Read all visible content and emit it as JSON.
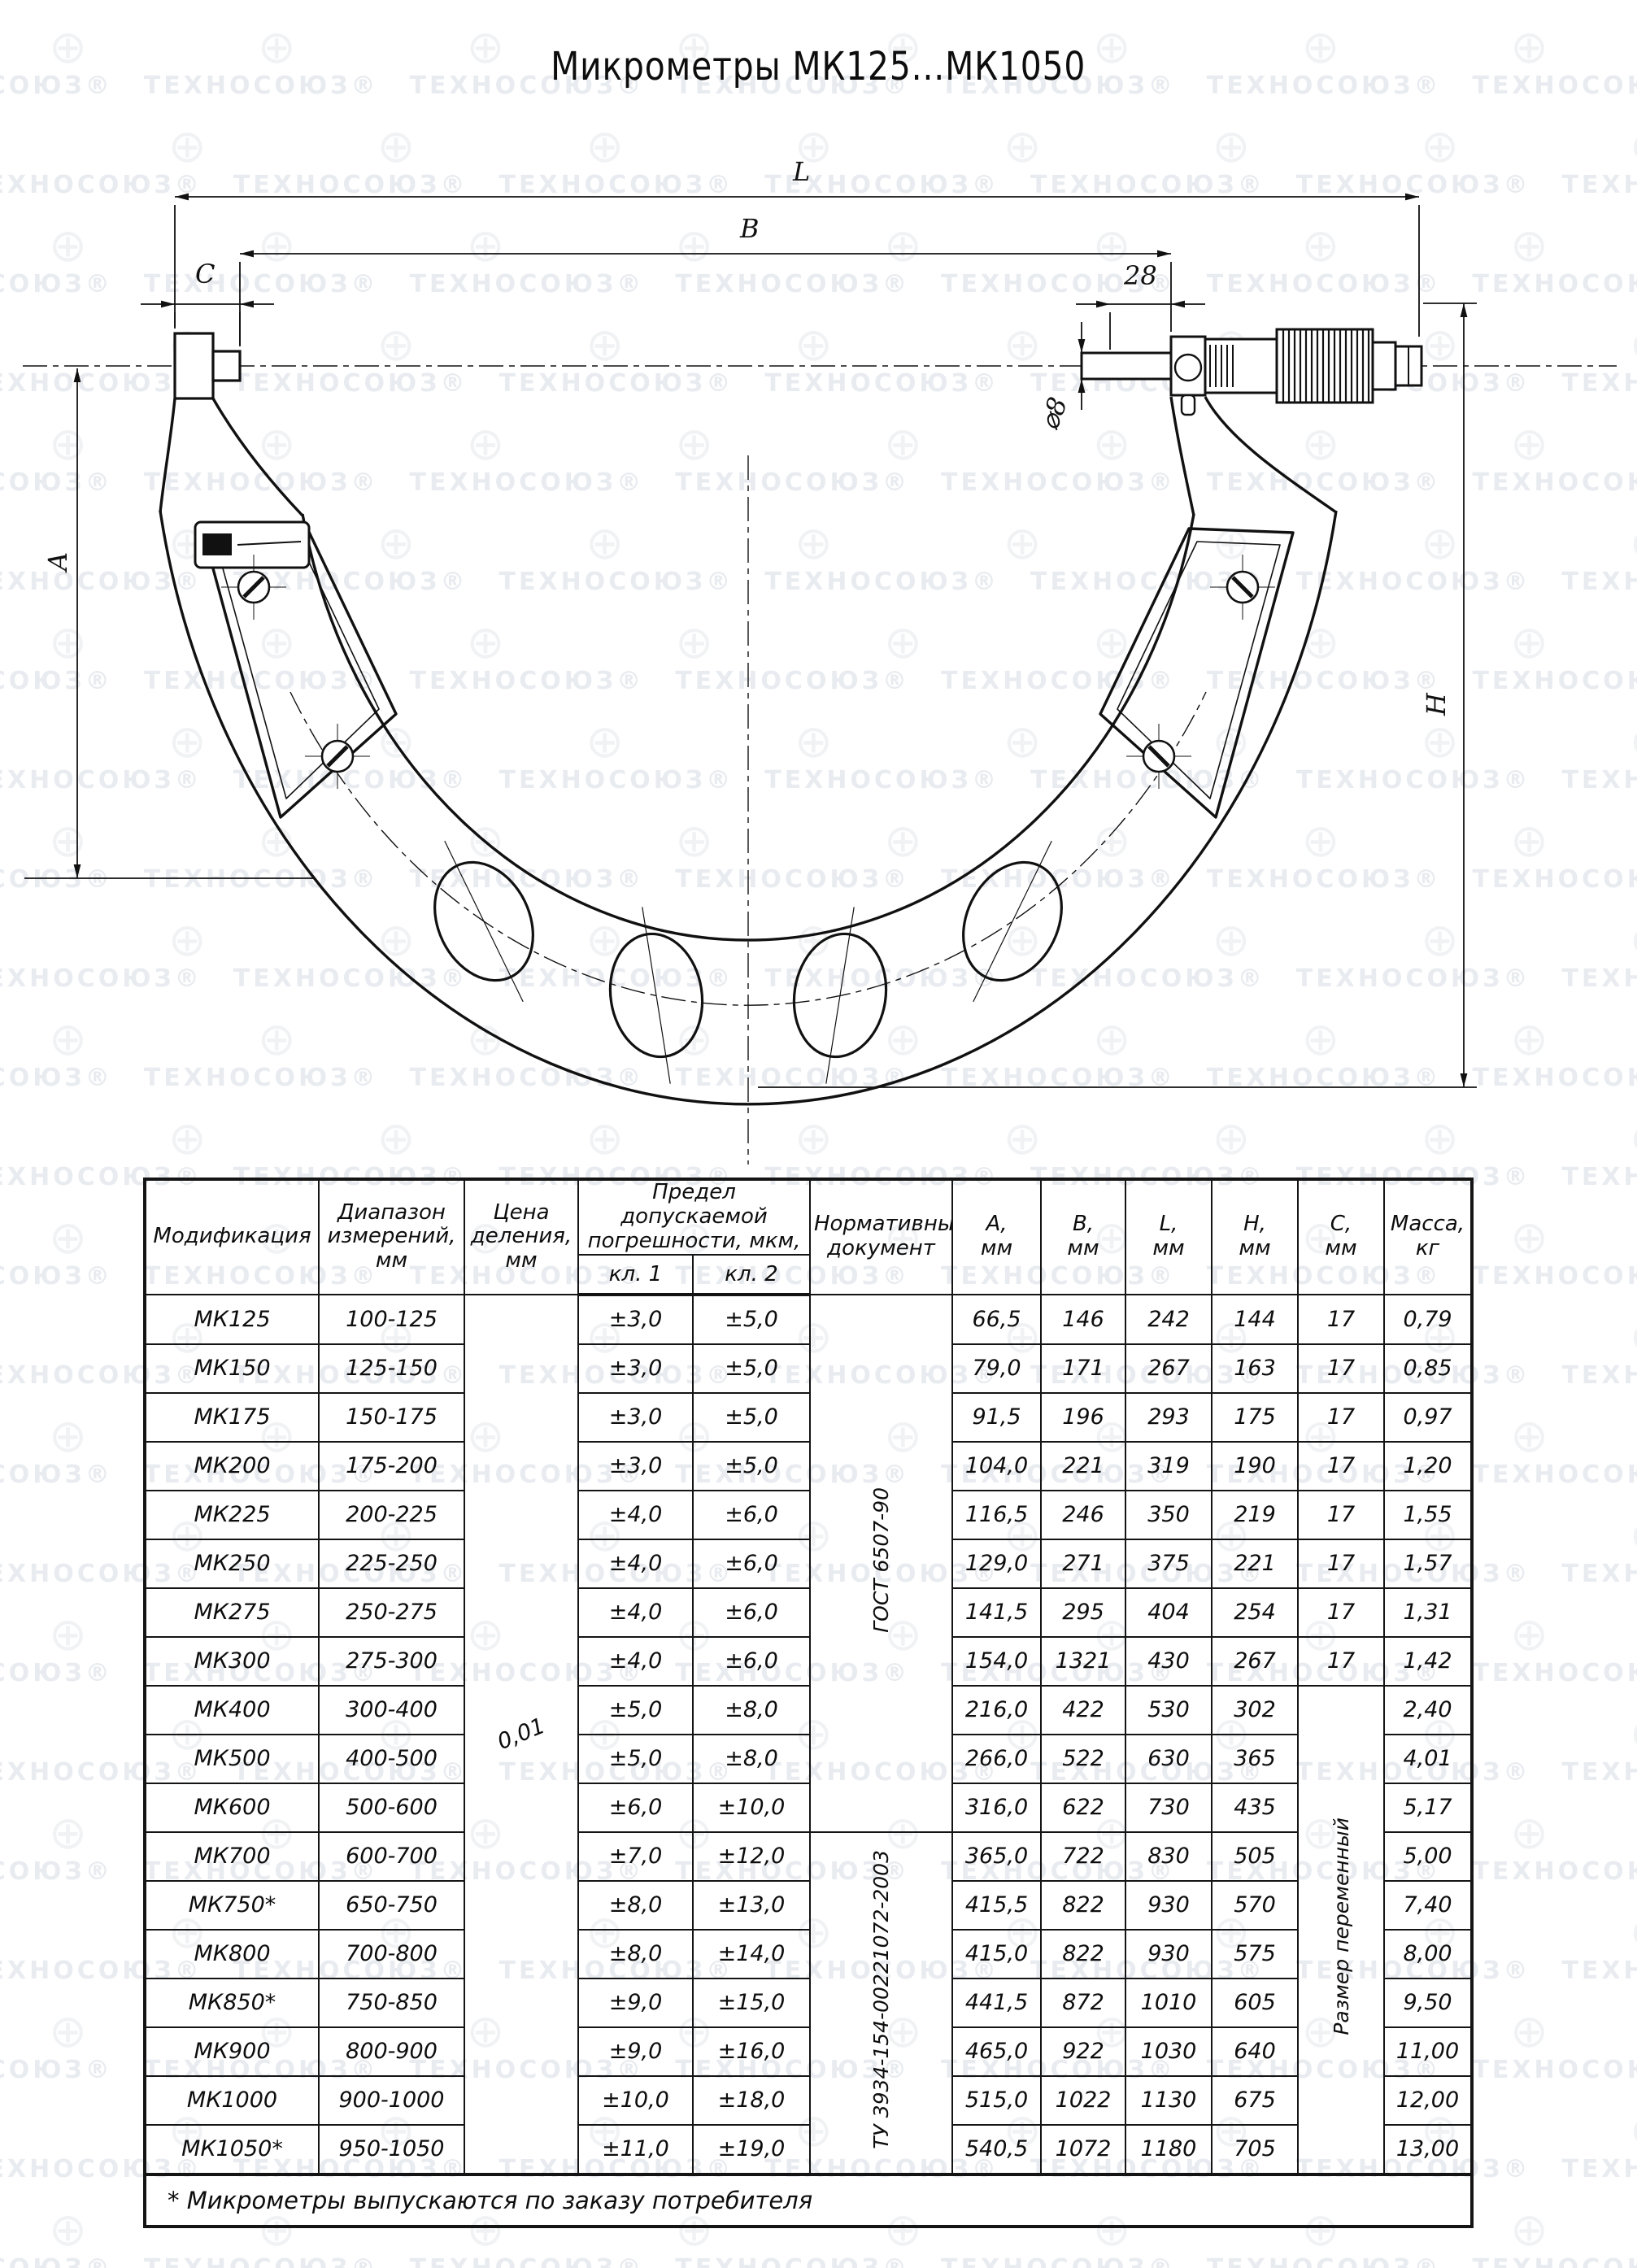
{
  "title": "Микрометры МК125...МК1050",
  "watermark": {
    "text": "ТЕХНОСОЮЗ",
    "reg": "®",
    "globe": "⊕"
  },
  "drawing": {
    "dim_labels": {
      "L": "L",
      "B": "B",
      "C": "C",
      "d28": "28",
      "dia8": "⌀8",
      "A": "A",
      "H": "H"
    }
  },
  "table": {
    "headers": {
      "modification": "Модификация",
      "range": "Диапазон измерений, мм",
      "pitch": "Цена деления, мм",
      "error": "Предел допускаемой погрешности, мкм,",
      "class1": "кл. 1",
      "class2": "кл. 2",
      "document": "Нормативный документ",
      "a": "А,",
      "b": "В,",
      "l": "L,",
      "h": "Н,",
      "c": "С,",
      "mm": "мм",
      "mass": "Масса,",
      "kg": "кг"
    },
    "merged": {
      "pitch_value": "0,01",
      "doc_gost": "ГОСТ 6507-90",
      "doc_tu": "ТУ 3934-154-00221072-2003",
      "c_variable": "Размер переменный"
    },
    "rows": [
      {
        "model": "МК125",
        "range": "100-125",
        "cl1": "±3,0",
        "cl2": "±5,0",
        "a": "66,5",
        "b": "146",
        "l": "242",
        "h": "144",
        "c": "17",
        "mass": "0,79"
      },
      {
        "model": "МК150",
        "range": "125-150",
        "cl1": "±3,0",
        "cl2": "±5,0",
        "a": "79,0",
        "b": "171",
        "l": "267",
        "h": "163",
        "c": "17",
        "mass": "0,85"
      },
      {
        "model": "МК175",
        "range": "150-175",
        "cl1": "±3,0",
        "cl2": "±5,0",
        "a": "91,5",
        "b": "196",
        "l": "293",
        "h": "175",
        "c": "17",
        "mass": "0,97"
      },
      {
        "model": "МК200",
        "range": "175-200",
        "cl1": "±3,0",
        "cl2": "±5,0",
        "a": "104,0",
        "b": "221",
        "l": "319",
        "h": "190",
        "c": "17",
        "mass": "1,20"
      },
      {
        "model": "МК225",
        "range": "200-225",
        "cl1": "±4,0",
        "cl2": "±6,0",
        "a": "116,5",
        "b": "246",
        "l": "350",
        "h": "219",
        "c": "17",
        "mass": "1,55"
      },
      {
        "model": "МК250",
        "range": "225-250",
        "cl1": "±4,0",
        "cl2": "±6,0",
        "a": "129,0",
        "b": "271",
        "l": "375",
        "h": "221",
        "c": "17",
        "mass": "1,57"
      },
      {
        "model": "МК275",
        "range": "250-275",
        "cl1": "±4,0",
        "cl2": "±6,0",
        "a": "141,5",
        "b": "295",
        "l": "404",
        "h": "254",
        "c": "17",
        "mass": "1,31"
      },
      {
        "model": "МК300",
        "range": "275-300",
        "cl1": "±4,0",
        "cl2": "±6,0",
        "a": "154,0",
        "b": "1321",
        "l": "430",
        "h": "267",
        "c": "17",
        "mass": "1,42"
      },
      {
        "model": "МК400",
        "range": "300-400",
        "cl1": "±5,0",
        "cl2": "±8,0",
        "a": "216,0",
        "b": "422",
        "l": "530",
        "h": "302",
        "mass": "2,40"
      },
      {
        "model": "МК500",
        "range": "400-500",
        "cl1": "±5,0",
        "cl2": "±8,0",
        "a": "266,0",
        "b": "522",
        "l": "630",
        "h": "365",
        "mass": "4,01"
      },
      {
        "model": "МК600",
        "range": "500-600",
        "cl1": "±6,0",
        "cl2": "±10,0",
        "a": "316,0",
        "b": "622",
        "l": "730",
        "h": "435",
        "mass": "5,17"
      },
      {
        "model": "МК700",
        "range": "600-700",
        "cl1": "±7,0",
        "cl2": "±12,0",
        "a": "365,0",
        "b": "722",
        "l": "830",
        "h": "505",
        "mass": "5,00"
      },
      {
        "model": "МК750*",
        "range": "650-750",
        "cl1": "±8,0",
        "cl2": "±13,0",
        "a": "415,5",
        "b": "822",
        "l": "930",
        "h": "570",
        "mass": "7,40"
      },
      {
        "model": "МК800",
        "range": "700-800",
        "cl1": "±8,0",
        "cl2": "±14,0",
        "a": "415,0",
        "b": "822",
        "l": "930",
        "h": "575",
        "mass": "8,00"
      },
      {
        "model": "МК850*",
        "range": "750-850",
        "cl1": "±9,0",
        "cl2": "±15,0",
        "a": "441,5",
        "b": "872",
        "l": "1010",
        "h": "605",
        "mass": "9,50"
      },
      {
        "model": "МК900",
        "range": "800-900",
        "cl1": "±9,0",
        "cl2": "±16,0",
        "a": "465,0",
        "b": "922",
        "l": "1030",
        "h": "640",
        "mass": "11,00"
      },
      {
        "model": "МК1000",
        "range": "900-1000",
        "cl1": "±10,0",
        "cl2": "±18,0",
        "a": "515,0",
        "b": "1022",
        "l": "1130",
        "h": "675",
        "mass": "12,00"
      },
      {
        "model": "МК1050*",
        "range": "950-1050",
        "cl1": "±11,0",
        "cl2": "±19,0",
        "a": "540,5",
        "b": "1072",
        "l": "1180",
        "h": "705",
        "mass": "13,00"
      }
    ]
  },
  "footnote": "* Микрометры выпускаются по заказу потребителя"
}
